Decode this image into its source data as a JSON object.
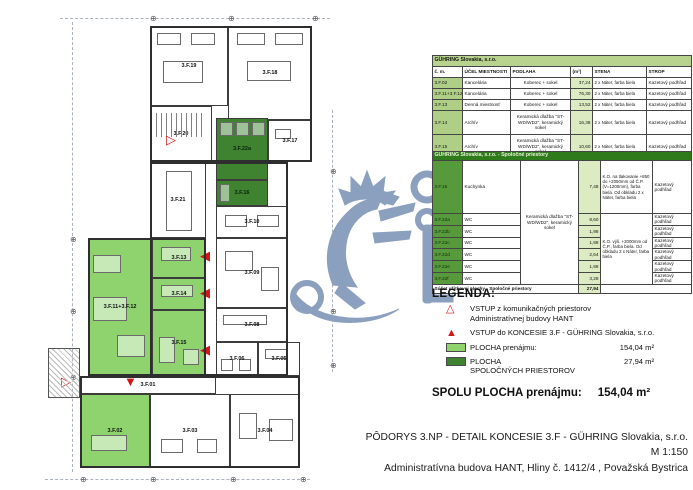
{
  "colors": {
    "rent_green": "#8fd36e",
    "common_green": "#3f8230",
    "common_id_green": "#569a3c",
    "table_band_green": "#b7d38d",
    "table_id_green": "#aecf85",
    "table_area_green": "#ddebc2",
    "common_band_green": "#2f7a1a",
    "red": "#d01818",
    "watermark_blue": "#8b9fbe"
  },
  "plan": {
    "rooms": [
      {
        "id": "3.F.19",
        "x": 150,
        "y": 26,
        "w": 78,
        "h": 80,
        "fill": "none",
        "furn": [
          [
            6,
            6,
            24,
            12
          ],
          [
            40,
            6,
            24,
            12
          ],
          [
            12,
            34,
            40,
            22
          ]
        ]
      },
      {
        "id": "3.F.18",
        "x": 228,
        "y": 26,
        "w": 84,
        "h": 94,
        "fill": "none",
        "furn": [
          [
            8,
            6,
            28,
            12
          ],
          [
            46,
            6,
            28,
            12
          ],
          [
            18,
            34,
            44,
            20
          ]
        ]
      },
      {
        "id": "3.F.20",
        "x": 150,
        "y": 106,
        "w": 62,
        "h": 56,
        "fill": "none",
        "stairs": true
      },
      {
        "id": "3.F.17",
        "x": 268,
        "y": 120,
        "w": 44,
        "h": 42,
        "fill": "none",
        "furn": [
          [
            6,
            8,
            16,
            10
          ]
        ]
      },
      {
        "id": "3.F.22a",
        "x": 216,
        "y": 118,
        "w": 52,
        "h": 62,
        "fill": "common",
        "furn": [
          [
            3,
            3,
            13,
            14
          ],
          [
            19,
            3,
            13,
            14
          ],
          [
            35,
            3,
            13,
            14
          ]
        ]
      },
      {
        "id": "3.F.16",
        "x": 216,
        "y": 180,
        "w": 52,
        "h": 26,
        "fill": "common",
        "furn": [
          [
            3,
            3,
            10,
            18
          ]
        ]
      },
      {
        "id": "3.F.21",
        "x": 150,
        "y": 162,
        "w": 56,
        "h": 76,
        "fill": "none",
        "furn": [
          [
            15,
            8,
            26,
            60
          ]
        ]
      },
      {
        "id": "3.F.10",
        "x": 216,
        "y": 206,
        "w": 72,
        "h": 32,
        "fill": "none",
        "furn": [
          [
            8,
            8,
            22,
            12
          ],
          [
            40,
            8,
            22,
            12
          ]
        ]
      },
      {
        "id": "3.F.09",
        "x": 216,
        "y": 238,
        "w": 72,
        "h": 70,
        "fill": "none",
        "furn": [
          [
            8,
            12,
            28,
            20
          ],
          [
            44,
            28,
            18,
            24
          ]
        ]
      },
      {
        "id": "3.F.08",
        "x": 216,
        "y": 308,
        "w": 72,
        "h": 34,
        "fill": "none",
        "furn": [
          [
            6,
            6,
            44,
            10
          ]
        ]
      },
      {
        "id": "3.F.06",
        "x": 216,
        "y": 342,
        "w": 42,
        "h": 34,
        "fill": "none",
        "furn": [
          [
            4,
            16,
            12,
            12
          ],
          [
            22,
            16,
            12,
            12
          ]
        ]
      },
      {
        "id": "3.F.05",
        "x": 258,
        "y": 342,
        "w": 42,
        "h": 34,
        "fill": "none",
        "furn": [
          [
            6,
            6,
            22,
            10
          ]
        ]
      },
      {
        "id": "3.F.11+3.F.12",
        "x": 88,
        "y": 238,
        "w": 64,
        "h": 138,
        "fill": "rent",
        "furn": [
          [
            4,
            16,
            28,
            18
          ],
          [
            4,
            58,
            34,
            24
          ],
          [
            28,
            96,
            28,
            22
          ]
        ]
      },
      {
        "id": "3.F.13",
        "x": 152,
        "y": 238,
        "w": 54,
        "h": 40,
        "fill": "rent",
        "furn": [
          [
            8,
            8,
            30,
            14
          ]
        ]
      },
      {
        "id": "3.F.14",
        "x": 152,
        "y": 278,
        "w": 54,
        "h": 32,
        "fill": "rent",
        "furn": [
          [
            8,
            6,
            32,
            12
          ]
        ]
      },
      {
        "id": "3.F.15",
        "x": 152,
        "y": 310,
        "w": 54,
        "h": 66,
        "fill": "rent",
        "furn": [
          [
            6,
            26,
            16,
            26
          ],
          [
            30,
            38,
            16,
            16
          ]
        ]
      },
      {
        "id": "3.F.01",
        "x": 80,
        "y": 376,
        "w": 136,
        "h": 18,
        "fill": "none",
        "furn": []
      },
      {
        "id": "3.F.02",
        "x": 80,
        "y": 394,
        "w": 70,
        "h": 74,
        "fill": "rent",
        "furn": [
          [
            10,
            40,
            36,
            16
          ]
        ]
      },
      {
        "id": "3.F.03",
        "x": 150,
        "y": 394,
        "w": 80,
        "h": 74,
        "fill": "none",
        "furn": [
          [
            10,
            44,
            22,
            14
          ],
          [
            46,
            44,
            20,
            14
          ]
        ]
      },
      {
        "id": "3.F.04",
        "x": 230,
        "y": 394,
        "w": 70,
        "h": 74,
        "fill": "none",
        "furn": [
          [
            8,
            18,
            18,
            26
          ],
          [
            38,
            24,
            24,
            22
          ]
        ]
      }
    ],
    "entries": [
      {
        "type": "filled",
        "dir": "left",
        "x": 200,
        "y": 249
      },
      {
        "type": "filled",
        "dir": "left",
        "x": 200,
        "y": 286
      },
      {
        "type": "filled",
        "dir": "left",
        "x": 200,
        "y": 343
      },
      {
        "type": "filled",
        "dir": "down",
        "x": 124,
        "y": 375
      },
      {
        "type": "outline",
        "dir": "right",
        "x": 61,
        "y": 375
      },
      {
        "type": "outline",
        "dir": "right",
        "x": 166,
        "y": 133
      }
    ],
    "markers": [
      [
        150,
        15
      ],
      [
        228,
        15
      ],
      [
        312,
        15
      ],
      [
        70,
        236
      ],
      [
        70,
        308
      ],
      [
        70,
        374
      ],
      [
        80,
        476
      ],
      [
        150,
        476
      ],
      [
        230,
        476
      ],
      [
        300,
        476
      ],
      [
        330,
        168
      ],
      [
        330,
        236
      ],
      [
        330,
        308
      ],
      [
        330,
        362
      ]
    ]
  },
  "tables": {
    "rent": {
      "title": "GÜHRING Slovakia, s.r.o.",
      "columns": [
        "č. m.",
        "ÚČEL MIESTNOSTI",
        "PODLAHA",
        "(m²)",
        "STENA",
        "STROP"
      ],
      "rows": [
        [
          "3.F.02",
          "Kancelária",
          "Koberec + sokel",
          "37,24",
          "2 x Náter, farba biela",
          "Kazetový podhľad"
        ],
        [
          "3.F.11+3.F.12",
          "Kancelária",
          "Koberec + sokel",
          "76,30",
          "2 x Náter, farba biela",
          "Kazetový podhľad"
        ],
        [
          "3.F.13",
          "Denná miestnosť",
          "Koberec + sokel",
          "13,52",
          "2 x Náter, farba biela",
          "Kazetový podhľad"
        ],
        [
          "3.F.14",
          "Archív",
          "Keramická dlažba \"ST-WD/WD2\", keramický sokel",
          "16,38",
          "2 x Náter, farba biela",
          "Kazetový podhľad"
        ],
        [
          "3.F.15",
          "Archív",
          "Keramická dlažba \"ST-WD/WD2\", keramický sokel",
          "10,60",
          "2 x Náter, farba biela",
          "Kazetový podhľad"
        ]
      ],
      "footer_label": "Súčet výmerov plochy GÜHRING Slovakia, s.r.o.",
      "footer_value": "154,04"
    },
    "common": {
      "title": "GÜHRING Slovakia, s.r.o. - Spoločné priestory",
      "floor_note": "Keramická dlažba \"ST-WD/WD2\", keramický sokel",
      "wall_note_1": "K.O. na tlakovanie +850 do +2050mm od Č.P. (V=1200mm), farba biela. Od obkladu 2 x Náter, farba biela",
      "wall_note_2": "K.O. výš. +2000mm od Č.P., farba biela. Od obkladu 2 x Náter, farba biela",
      "rows": [
        [
          "3.F.16",
          "Kuchynka",
          "7,48",
          "Kazetový podhľad"
        ],
        [
          "3.F.22a",
          "WC",
          "8,60",
          "Kazetový podhľad"
        ],
        [
          "3.F.22b",
          "WC",
          "1,98",
          "Kazetový podhľad"
        ],
        [
          "3.F.22c",
          "WC",
          "1,98",
          "Kazetový podhľad"
        ],
        [
          "3.F.22d",
          "WC",
          "2,64",
          "Kazetový podhľad"
        ],
        [
          "3.F.22e",
          "WC",
          "1,98",
          "Kazetový podhľad"
        ],
        [
          "3.F.22f",
          "WC",
          "3,28",
          "Kazetový podhľad"
        ]
      ],
      "footer_label": "Súčet užitkovej plochy - Spoločné priestory",
      "footer_value": "27,94"
    }
  },
  "legend": {
    "title": "LEGENDA:",
    "entry_outline": [
      "VSTUP z komunikačných priestorov",
      "Administratívnej budovy HANT"
    ],
    "entry_filled": "VSTUP do KONCESIE 3.F - GÜHRING Slovakia, s.r.o.",
    "rent_label": "PLOCHA prenájmu:",
    "rent_value": "154,04 m²",
    "common_label_1": "PLOCHA",
    "common_label_2": "SPOLOČNÝCH PRIESTOROV",
    "common_value": "27,94 m²",
    "total_label": "SPOLU PLOCHA prenájmu:",
    "total_value": "154,04 m²"
  },
  "titleblock": {
    "line1": "PÔDORYS 3.NP - DETAIL KONCESIE 3.F - GÜHRING Slovakia, s.r.o.",
    "line2": "M  1:150",
    "line3": "Administratívna budova HANT, Hliny č. 1412/4 , Považská Bystrica"
  }
}
